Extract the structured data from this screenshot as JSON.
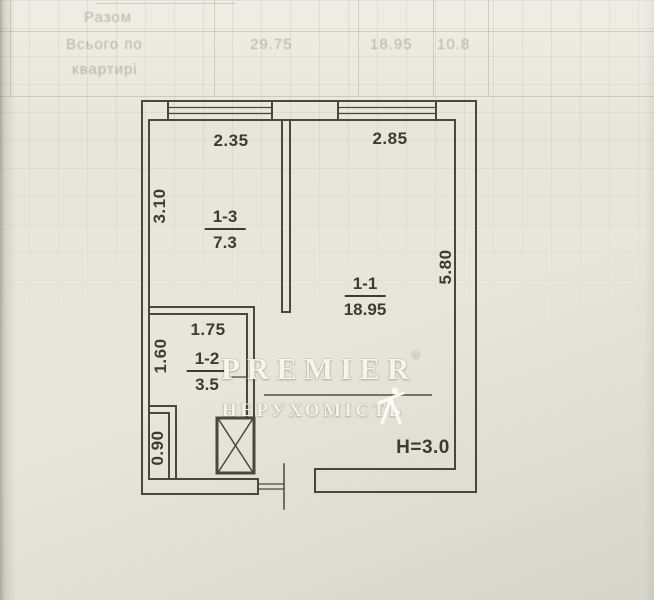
{
  "faint_header": {
    "row1": "Разом",
    "row2": "Всього по",
    "row3": "квартирі",
    "values": [
      "29.75",
      "18.95",
      "10.8"
    ]
  },
  "plan": {
    "dims": {
      "top_left_width": "2.35",
      "top_right_width": "2.85",
      "left_height": "3.10",
      "right_height": "5.80",
      "hall_width": "1.75",
      "hall_height": "1.60",
      "niche_height": "0.90",
      "ceiling_height": "H=3.0"
    },
    "rooms": [
      {
        "number": "1-3",
        "area": "7.3"
      },
      {
        "number": "1-1",
        "area": "18.95"
      },
      {
        "number": "1-2",
        "area": "3.5"
      }
    ]
  },
  "watermark": {
    "brand": "PREMIER",
    "reg": "®",
    "subtitle": "НЕРУХОМІСТЬ"
  },
  "colors": {
    "paper": "#e8e6da",
    "line": "#3c3a34",
    "watermark": "#fbfaf5"
  }
}
